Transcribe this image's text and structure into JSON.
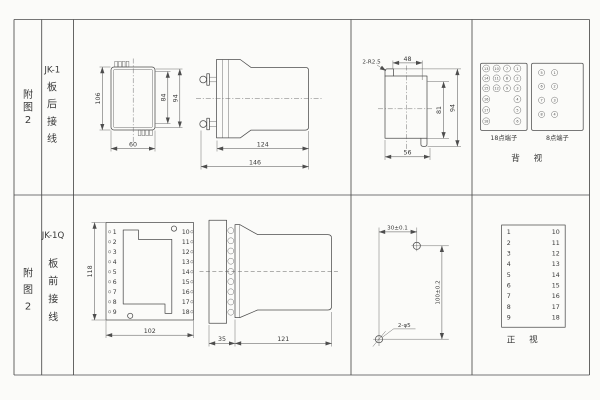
{
  "left_panel": {
    "top": {
      "fig_chars": [
        "附",
        "图",
        "2"
      ],
      "model": "JK-1",
      "wiring_chars": [
        "板",
        "后",
        "接",
        "线"
      ]
    },
    "bottom": {
      "fig_chars": [
        "附",
        "图",
        "2"
      ],
      "model": "JK-1Q",
      "wiring_chars": [
        "板",
        "前",
        "接",
        "线"
      ]
    }
  },
  "jk1": {
    "rear_view": {
      "dim_height": "106",
      "dim_inner_height": "84",
      "dim_outer_height": "94",
      "dim_width": "60"
    },
    "side_view": {
      "dim_body_length": "124",
      "dim_total_length": "146"
    },
    "profile_view": {
      "radius_note": "2-R2.5",
      "dim_top_width": "48",
      "dim_inner_height": "81",
      "dim_outer_height": "94",
      "dim_bottom_width": "56"
    },
    "rear_terminals": {
      "label_18pt": "18点端子",
      "label_8pt": "8点端子",
      "view_label": "背 视",
      "block18": {
        "col1": [
          "13",
          "14",
          "15",
          "16",
          "17",
          "18"
        ],
        "col2": [
          "10",
          "11",
          "12"
        ],
        "col3": [
          "7",
          "8",
          "9"
        ],
        "col4": [
          "1",
          "2",
          "3",
          "4",
          "5",
          "6"
        ]
      },
      "block8": {
        "left": [
          "5",
          "6",
          "7",
          "8"
        ],
        "right": [
          "1",
          "2",
          "3",
          "4"
        ]
      }
    }
  },
  "jk1q": {
    "front_view": {
      "dim_height": "118",
      "dim_width": "102",
      "left_terminals": [
        "1",
        "2",
        "3",
        "4",
        "5",
        "6",
        "7",
        "8",
        "9"
      ],
      "right_terminals": [
        "10",
        "11",
        "12",
        "13",
        "14",
        "15",
        "16",
        "17",
        "18"
      ]
    },
    "side_view": {
      "dim_panel_depth": "35",
      "dim_body_length": "121"
    },
    "drill_template": {
      "dim_horizontal": "30±0.1",
      "dim_vertical": "100±0.2",
      "hole_note": "2-φ5"
    },
    "terminal_table": {
      "left": [
        "1",
        "2",
        "3",
        "4",
        "5",
        "6",
        "7",
        "8",
        "9"
      ],
      "right": [
        "10",
        "11",
        "12",
        "13",
        "14",
        "15",
        "16",
        "17",
        "18"
      ],
      "view_label": "正 视"
    }
  }
}
